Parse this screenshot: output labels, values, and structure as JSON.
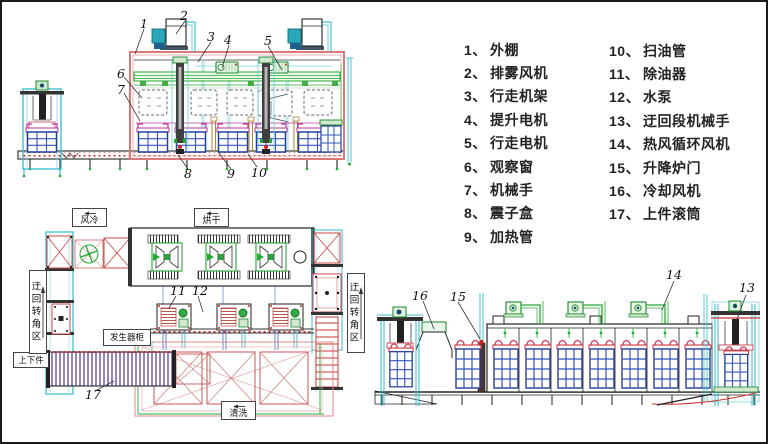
{
  "legend": {
    "col1": [
      {
        "num": "1、",
        "label": "外棚"
      },
      {
        "num": "2、",
        "label": "排雾风机"
      },
      {
        "num": "3、",
        "label": "行走机架"
      },
      {
        "num": "4、",
        "label": "提升电机"
      },
      {
        "num": "5、",
        "label": "行走电机"
      },
      {
        "num": "6、",
        "label": "观察窗"
      },
      {
        "num": "7、",
        "label": "机械手"
      },
      {
        "num": "8、",
        "label": "震子盒"
      },
      {
        "num": "9、",
        "label": "加热管"
      }
    ],
    "col2": [
      {
        "num": "10、",
        "label": "扫油管"
      },
      {
        "num": "11、",
        "label": "除油器"
      },
      {
        "num": "12、",
        "label": "水泵"
      },
      {
        "num": "13、",
        "label": "迂回段机械手"
      },
      {
        "num": "14、",
        "label": "热风循环风机"
      },
      {
        "num": "15、",
        "label": "升降炉门"
      },
      {
        "num": "16、",
        "label": "冷却风机"
      },
      {
        "num": "17、",
        "label": "上件滚筒"
      }
    ]
  },
  "area_labels": {
    "air_cooling": "风冷",
    "drying": "烘干",
    "cleaning": "清洗",
    "detour_left": "迂回转角区",
    "detour_right": "迂回转角区",
    "load_unload": "上下件",
    "generator_cabinet": "发生器柜"
  },
  "callouts": {
    "c1": "1",
    "c2": "2",
    "c3": "3",
    "c4": "4",
    "c5": "5",
    "c6": "6",
    "c7": "7",
    "c8": "8",
    "c9": "9",
    "c10": "10",
    "c11": "11",
    "c12": "12",
    "c13": "13",
    "c14": "14",
    "c15": "15",
    "c16": "16",
    "c17": "17"
  },
  "colors": {
    "frame_red": "#dd7777",
    "bright_red": "#cc2222",
    "green": "#22aa33",
    "cyan": "#33bbcc",
    "grid_blue": "#3355bb",
    "magenta": "#bb3399",
    "stripe_purple": "#9384c8",
    "dark": "#222222"
  }
}
